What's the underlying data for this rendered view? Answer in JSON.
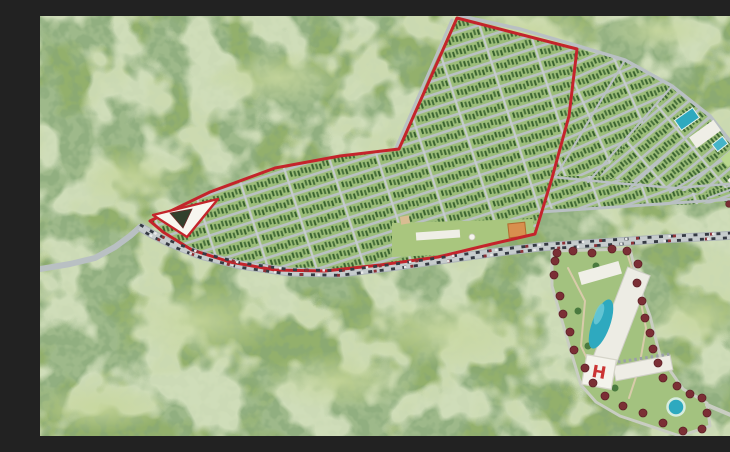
{
  "scene": {
    "width": 730,
    "height": 420,
    "label": "aerial-master-plan-rendering"
  },
  "palette": {
    "forest_base": "#93b06c",
    "forest_dark": "#5a7f45",
    "forest_speckle": "#3c6130",
    "forest_light": "#c7d79c",
    "plot_green": "#9cbd79",
    "tree_row_a": "#47703b",
    "tree_row_b": "#39622f",
    "road_gray": "#b9c0c3",
    "road_light": "#c6cccd",
    "boundary_red": "#c4242b",
    "pool_blue": "#2ea9bf",
    "pool_light": "#6ecbd8",
    "building_white": "#efeee6",
    "maroon_tree": "#7b2f35",
    "orange_building": "#d88f4e",
    "park_green": "#a9c67e",
    "lawn_green": "#a3c27f",
    "path_tan": "#d8cbaa",
    "monument_dark": "#31402c",
    "car_dark": "#353a43",
    "car_red": "#8e3136",
    "car_white": "#e9eaea",
    "helipad_red": "#cb3434"
  },
  "forest_layers": [
    {
      "name": "forest-dark-blobs",
      "color": "#5a7f45",
      "bf": 0.014,
      "oct": 3,
      "seed": 7,
      "mul": 9,
      "off": -3.9,
      "opacity": 0.9
    },
    {
      "name": "forest-speckle",
      "color": "#3c6130",
      "bf": 0.1,
      "oct": 2,
      "seed": 12,
      "mul": 6,
      "off": -2.6,
      "opacity": 0.5
    },
    {
      "name": "forest-light-patch",
      "color": "#c7d79c",
      "bf": 0.02,
      "oct": 3,
      "seed": 31,
      "mul": 8,
      "off": -3.6,
      "opacity": 0.7
    }
  ],
  "meadows": [
    [
      480,
      18,
      95,
      26
    ],
    [
      240,
      62,
      70,
      28
    ],
    [
      90,
      160,
      55,
      30
    ],
    [
      160,
      305,
      85,
      38
    ],
    [
      400,
      315,
      95,
      36
    ],
    [
      660,
      300,
      55,
      32
    ],
    [
      620,
      15,
      55,
      20
    ],
    [
      300,
      365,
      80,
      30
    ],
    [
      60,
      392,
      70,
      25
    ]
  ],
  "subdivision": {
    "row_spacing": 13,
    "cross_spacing": 46,
    "road_w": 2.6,
    "cross_w": 2.2,
    "blocks": [
      {
        "name": "parcel-block-inside-boundary",
        "angle": -18,
        "points": [
          [
            417,
            2
          ],
          [
            537,
            33
          ],
          [
            529,
            100
          ],
          [
            512,
            162
          ],
          [
            495,
            218
          ],
          [
            452,
            228
          ],
          [
            398,
            241
          ],
          [
            340,
            249
          ],
          [
            285,
            255
          ],
          [
            235,
            254
          ],
          [
            190,
            246
          ],
          [
            152,
            234
          ],
          [
            123,
            216
          ],
          [
            110,
            205
          ],
          [
            170,
            176
          ],
          [
            235,
            152
          ],
          [
            300,
            140
          ],
          [
            359,
            133
          ]
        ]
      },
      {
        "name": "parcel-block-fan-upper",
        "angle": -24,
        "points": [
          [
            537,
            33
          ],
          [
            585,
            44
          ],
          [
            632,
            70
          ],
          [
            560,
            160
          ],
          [
            513,
            160
          ],
          [
            529,
            100
          ]
        ]
      },
      {
        "name": "parcel-block-fan-outer",
        "angle": -40,
        "points": [
          [
            632,
            70
          ],
          [
            670,
            100
          ],
          [
            698,
            135
          ],
          [
            712,
            166
          ],
          [
            660,
            178
          ],
          [
            560,
            160
          ]
        ]
      },
      {
        "name": "parcel-block-fan-lower",
        "angle": -20,
        "points": [
          [
            513,
            160
          ],
          [
            560,
            160
          ],
          [
            660,
            178
          ],
          [
            712,
            166
          ],
          [
            716,
            184
          ],
          [
            660,
            188
          ],
          [
            580,
            191
          ],
          [
            505,
            193
          ],
          [
            494,
            216
          ],
          [
            512,
            162
          ]
        ]
      }
    ],
    "extra_roads": [
      {
        "name": "outer-arc-road",
        "w": 3.5,
        "points": [
          [
            421,
            0
          ],
          [
            480,
            13
          ],
          [
            535,
            29
          ],
          [
            585,
            44
          ],
          [
            632,
            70
          ],
          [
            670,
            100
          ],
          [
            698,
            135
          ],
          [
            712,
            166
          ],
          [
            717,
            195
          ],
          [
            714,
            214
          ]
        ]
      },
      {
        "name": "west-edge-road",
        "w": 3,
        "points": [
          [
            412,
            4
          ],
          [
            356,
            132
          ]
        ]
      },
      {
        "name": "boundary-edge-road",
        "w": 3,
        "points": [
          [
            537,
            33
          ],
          [
            529,
            100
          ],
          [
            512,
            162
          ],
          [
            495,
            218
          ]
        ]
      },
      {
        "name": "mid-arc-road",
        "w": 2.5,
        "points": [
          [
            513,
            161
          ],
          [
            575,
            167
          ],
          [
            635,
            172
          ],
          [
            688,
            168
          ],
          [
            711,
            166
          ]
        ]
      },
      {
        "name": "inner-frontage-road",
        "w": 3,
        "points": [
          [
            500,
            196
          ],
          [
            560,
            192
          ],
          [
            620,
            188
          ],
          [
            680,
            184
          ],
          [
            730,
            181
          ]
        ]
      },
      {
        "name": "radial-road-1",
        "w": 2.2,
        "points": [
          [
            516,
            160
          ],
          [
            585,
            44
          ]
        ]
      },
      {
        "name": "radial-road-2",
        "w": 2.2,
        "points": [
          [
            548,
            166
          ],
          [
            632,
            70
          ]
        ]
      },
      {
        "name": "radial-road-3",
        "w": 2.2,
        "points": [
          [
            590,
            172
          ],
          [
            670,
            100
          ]
        ]
      },
      {
        "name": "radial-road-4",
        "w": 2.2,
        "points": [
          [
            630,
            176
          ],
          [
            698,
            135
          ]
        ]
      },
      {
        "name": "radial-road-5",
        "w": 2.2,
        "points": [
          [
            668,
            182
          ],
          [
            712,
            166
          ]
        ]
      }
    ]
  },
  "boundary": {
    "color": "#c4242b",
    "width": 3,
    "points": [
      [
        417,
        2
      ],
      [
        537,
        33
      ],
      [
        529,
        100
      ],
      [
        512,
        162
      ],
      [
        495,
        218
      ],
      [
        452,
        228
      ],
      [
        398,
        241
      ],
      [
        340,
        249
      ],
      [
        285,
        255
      ],
      [
        235,
        254
      ],
      [
        190,
        246
      ],
      [
        152,
        234
      ],
      [
        123,
        216
      ],
      [
        110,
        205
      ],
      [
        170,
        176
      ],
      [
        235,
        152
      ],
      [
        300,
        140
      ],
      [
        359,
        133
      ]
    ]
  },
  "roads": {
    "main": {
      "w": 9,
      "points": [
        [
          100,
          211
        ],
        [
          112,
          218
        ],
        [
          130,
          227
        ],
        [
          160,
          239
        ],
        [
          200,
          249
        ],
        [
          250,
          256
        ],
        [
          300,
          257
        ],
        [
          350,
          251
        ],
        [
          400,
          244
        ],
        [
          450,
          237
        ],
        [
          500,
          231
        ],
        [
          560,
          227
        ],
        [
          620,
          223
        ],
        [
          680,
          220
        ],
        [
          730,
          217
        ]
      ]
    },
    "access": {
      "w": 6,
      "points": [
        [
          0,
          253
        ],
        [
          30,
          248
        ],
        [
          55,
          242
        ],
        [
          75,
          231
        ],
        [
          90,
          220
        ],
        [
          100,
          211
        ]
      ]
    }
  },
  "traffic": {
    "lane_offsets": [
      -2.3,
      2.3
    ],
    "streams": [
      {
        "name": "cars-dark",
        "color": "#353a43",
        "w": 2.8,
        "dash": "4 7.5",
        "offset": 0
      },
      {
        "name": "cars-red",
        "color": "#8e3136",
        "w": 2.8,
        "dash": "3 34",
        "offset": 12
      },
      {
        "name": "cars-white",
        "color": "#e9eaea",
        "w": 2.4,
        "dash": "2.5 41",
        "offset": 27
      }
    ]
  },
  "entrance": {
    "triangle": [
      [
        113,
        199
      ],
      [
        178,
        183
      ],
      [
        147,
        221
      ]
    ],
    "monument": [
      [
        130,
        197
      ],
      [
        152,
        193
      ],
      [
        143,
        212
      ]
    ]
  },
  "park_strip": {
    "polygon": [
      [
        352,
        207
      ],
      [
        493,
        203
      ],
      [
        494,
        218
      ],
      [
        452,
        227
      ],
      [
        398,
        239
      ],
      [
        352,
        241
      ]
    ],
    "buildings": [
      {
        "name": "park-long-building",
        "c": [
          398,
          219
        ],
        "w": 44,
        "h": 8,
        "a": -4,
        "fill": "#efeee6"
      },
      {
        "name": "park-small-building",
        "c": [
          365,
          204
        ],
        "w": 9,
        "h": 8,
        "a": -10,
        "fill": "#d9bd92"
      },
      {
        "name": "clubhouse-orange",
        "c": [
          477,
          214
        ],
        "w": 17,
        "h": 14,
        "a": -6,
        "fill": "#d88f4e",
        "stroke": "#b06a2e"
      }
    ],
    "gazebo": [
      432,
      221
    ]
  },
  "amenities_ne": [
    {
      "name": "amenity-pool-1",
      "c": [
        647,
        103
      ],
      "w": 22,
      "h": 12,
      "a": -35,
      "fill": "#2ea9bf",
      "stroke": "#e8f2ef"
    },
    {
      "name": "amenity-building-1",
      "c": [
        665,
        118
      ],
      "w": 30,
      "h": 13,
      "a": -36,
      "fill": "#efeee6"
    },
    {
      "name": "amenity-pool-2",
      "c": [
        680,
        128
      ],
      "w": 13,
      "h": 9,
      "a": -38,
      "fill": "#45b4c8",
      "stroke": "#e8f2ef"
    },
    {
      "name": "amenity-green",
      "c": [
        691,
        141
      ],
      "w": 18,
      "h": 11,
      "a": -42,
      "fill": "#b9d78f"
    },
    {
      "name": "amenity-building-2",
      "c": [
        703,
        157
      ],
      "w": 32,
      "h": 13,
      "a": -48,
      "fill": "#efeee6"
    }
  ],
  "roadside_building": {
    "rect": {
      "c": [
        713,
        192
      ],
      "w": 32,
      "h": 11,
      "a": -7,
      "fill": "#efeee6"
    },
    "trees": [
      [
        689,
        188
      ],
      [
        700,
        184
      ],
      [
        711,
        181
      ],
      [
        722,
        179
      ],
      [
        730,
        177
      ]
    ]
  },
  "resort": {
    "perimeter": [
      [
        512,
        235
      ],
      [
        590,
        233
      ],
      [
        598,
        267
      ],
      [
        610,
        300
      ],
      [
        620,
        340
      ],
      [
        643,
        373
      ],
      [
        667,
        387
      ],
      [
        670,
        410
      ],
      [
        640,
        420
      ],
      [
        580,
        400
      ],
      [
        556,
        386
      ],
      [
        541,
        369
      ],
      [
        529,
        329
      ],
      [
        512,
        270
      ]
    ],
    "exit_road": [
      [
        667,
        389
      ],
      [
        700,
        403
      ],
      [
        730,
        411
      ]
    ],
    "inner_paths": [
      [
        [
          528,
          252
        ],
        [
          545,
          285
        ],
        [
          541,
          330
        ],
        [
          556,
          362
        ]
      ],
      [
        [
          588,
          240
        ],
        [
          598,
          272
        ],
        [
          606,
          312
        ],
        [
          599,
          352
        ],
        [
          589,
          382
        ]
      ]
    ],
    "buildings": [
      {
        "name": "hotel-main-slab",
        "c": [
          581,
          302
        ],
        "w": 24,
        "h": 100,
        "a": 21,
        "fill": "#edece4",
        "stroke": "#cfcfc6"
      },
      {
        "name": "hotel-top-wing",
        "c": [
          560,
          257
        ],
        "w": 42,
        "h": 13,
        "a": -16,
        "fill": "#f0efe7"
      },
      {
        "name": "hotel-low-wing",
        "c": [
          603,
          352
        ],
        "w": 58,
        "h": 15,
        "a": -11,
        "fill": "#eeede5",
        "stroke": "#cfcfc6"
      }
    ],
    "balcony_line": [
      [
        578,
        346
      ],
      [
        630,
        338
      ]
    ],
    "lagoon_pool": {
      "c": [
        561,
        308
      ],
      "rx": 9,
      "ry": 26,
      "a": 20
    },
    "pool_highlight": {
      "c": [
        559,
        298
      ],
      "rx": 4,
      "ry": 11,
      "a": 20
    },
    "helipad": {
      "c": [
        559,
        356
      ],
      "size": 30,
      "a": 10,
      "label": "H"
    },
    "round_pool": {
      "c": [
        636,
        391
      ],
      "r": 8.5
    },
    "maroon_trees": [
      [
        517,
        237
      ],
      [
        533,
        235
      ],
      [
        552,
        237
      ],
      [
        572,
        233
      ],
      [
        587,
        235
      ],
      [
        598,
        248
      ],
      [
        597,
        267
      ],
      [
        602,
        285
      ],
      [
        605,
        302
      ],
      [
        610,
        317
      ],
      [
        613,
        333
      ],
      [
        618,
        347
      ],
      [
        623,
        362
      ],
      [
        637,
        370
      ],
      [
        650,
        378
      ],
      [
        662,
        382
      ],
      [
        667,
        397
      ],
      [
        662,
        413
      ],
      [
        643,
        415
      ],
      [
        623,
        407
      ],
      [
        603,
        397
      ],
      [
        583,
        390
      ],
      [
        565,
        380
      ],
      [
        553,
        367
      ],
      [
        545,
        352
      ],
      [
        534,
        334
      ],
      [
        530,
        316
      ],
      [
        523,
        298
      ],
      [
        520,
        280
      ],
      [
        514,
        259
      ],
      [
        515,
        245
      ]
    ],
    "green_trees": [
      [
        548,
        330
      ],
      [
        538,
        295
      ],
      [
        575,
        372
      ],
      [
        556,
        250
      ]
    ]
  }
}
